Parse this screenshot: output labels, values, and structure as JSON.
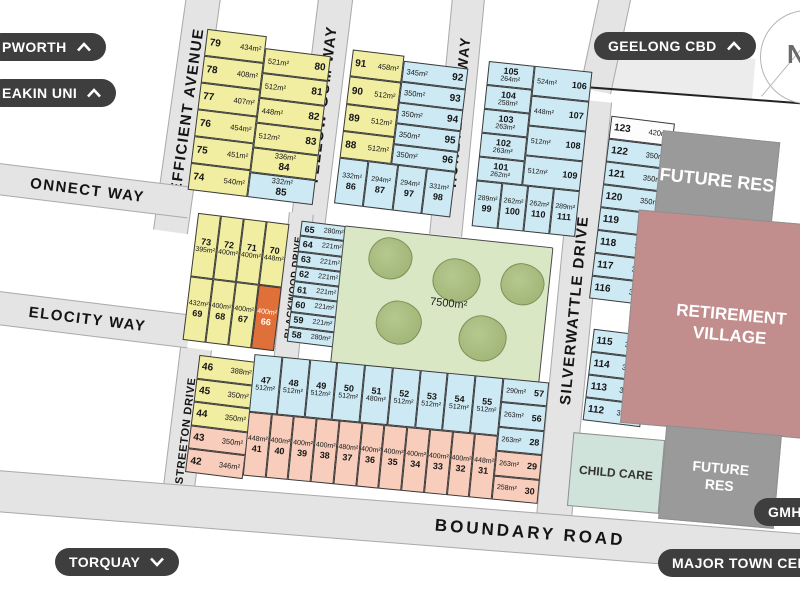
{
  "badges": {
    "top_left_1": {
      "label": "PWORTH",
      "chevron": "up"
    },
    "top_left_2": {
      "label": "EAKIN UNI",
      "chevron": "up"
    },
    "top_right": {
      "label": "GEELONG CBD",
      "chevron": "up"
    },
    "bottom_left": {
      "label": "TORQUAY",
      "chevron": "down"
    },
    "bottom_right_1": {
      "label": "GMHBA",
      "chevron": "none"
    },
    "bottom_right_2": {
      "label": "MAJOR TOWN CENTRE",
      "chevron": "none"
    }
  },
  "compass": {
    "label": "N"
  },
  "roads": {
    "efficient_avenue": "EFFICIENT AVENUE",
    "connect_way": "ONNECT WAY",
    "velocity_way": "ELOCITY WAY",
    "yellow_gum_way": "YELLOW GUM WAY",
    "honeyeater_way": "HONEYEATER WAY",
    "blackwood_drive": "BLACKWOOD DRIVE",
    "silverwattle_drive": "SILVERWATTLE DRIVE",
    "streeton_drive": "STREETON DRIVE",
    "boundary_road": "BOUNDARY ROAD"
  },
  "park": {
    "area_label": "7500m²"
  },
  "zones": {
    "future_res_top": "FUTURE RES",
    "retirement_village": "RETIREMENT VILLAGE",
    "child_care": "CHILD CARE",
    "future_res_bottom": "FUTURE RES"
  },
  "colors": {
    "lot_yellow": "#f1eda1",
    "lot_blue": "#cde9f4",
    "lot_salmon": "#f8cdbb",
    "lot_highlight_orange": "#e0703a",
    "park_green": "#d9e7c4",
    "tree_green": "#9cb173",
    "retirement_rose": "#c28e8d",
    "reserve_gray": "#9a9a9a",
    "childcare_teal": "#cfe3da",
    "road_gray": "#e4e4e4",
    "badge_dark": "#3e3e3e"
  },
  "lots": {
    "block_a_left": [
      {
        "n": "79",
        "a": "434m²",
        "c": "y",
        "v": "na"
      },
      {
        "n": "78",
        "a": "408m²",
        "c": "y",
        "v": "na"
      },
      {
        "n": "77",
        "a": "407m²",
        "c": "y",
        "v": "na"
      },
      {
        "n": "76",
        "a": "454m²",
        "c": "y",
        "v": "na"
      },
      {
        "n": "75",
        "a": "451m²",
        "c": "y",
        "v": "na"
      },
      {
        "n": "74",
        "a": "540m²",
        "c": "y",
        "v": "na"
      }
    ],
    "block_a_right": [
      {
        "n": "80",
        "a": "521m²",
        "c": "y",
        "v": "an"
      },
      {
        "n": "81",
        "a": "512m²",
        "c": "y",
        "v": "an"
      },
      {
        "n": "82",
        "a": "448m²",
        "c": "y",
        "v": "an"
      },
      {
        "n": "83",
        "a": "512m²",
        "c": "y",
        "v": "an"
      },
      {
        "n": "84",
        "a": "336m²",
        "c": "y",
        "v": "san"
      },
      {
        "n": "85",
        "a": "332m²",
        "c": "b",
        "v": "san"
      }
    ],
    "block_b_left": [
      {
        "n": "91",
        "a": "458m²",
        "c": "y",
        "v": "na"
      },
      {
        "n": "90",
        "a": "512m²",
        "c": "y",
        "v": "na"
      },
      {
        "n": "89",
        "a": "512m²",
        "c": "y",
        "v": "na"
      },
      {
        "n": "88",
        "a": "512m²",
        "c": "y",
        "v": "na"
      }
    ],
    "block_b_right": [
      {
        "n": "92",
        "a": "345m²",
        "c": "b",
        "v": "an"
      },
      {
        "n": "93",
        "a": "350m²",
        "c": "b",
        "v": "an"
      },
      {
        "n": "94",
        "a": "350m²",
        "c": "b",
        "v": "an"
      },
      {
        "n": "95",
        "a": "350m²",
        "c": "b",
        "v": "an"
      },
      {
        "n": "96",
        "a": "350m²",
        "c": "b",
        "v": "an"
      }
    ],
    "block_b_bottom": [
      {
        "n": "86",
        "a": "332m²",
        "c": "b",
        "v": "san"
      },
      {
        "n": "87",
        "a": "294m²",
        "c": "b",
        "v": "san"
      },
      {
        "n": "97",
        "a": "294m²",
        "c": "b",
        "v": "san"
      },
      {
        "n": "98",
        "a": "331m²",
        "c": "b",
        "v": "san"
      }
    ],
    "block_c_left": [
      {
        "n": "105",
        "a": "264m²",
        "c": "b",
        "v": "sna"
      },
      {
        "n": "104",
        "a": "258m²",
        "c": "b",
        "v": "sna"
      },
      {
        "n": "103",
        "a": "263m²",
        "c": "b",
        "v": "sna"
      },
      {
        "n": "102",
        "a": "263m²",
        "c": "b",
        "v": "sna"
      },
      {
        "n": "101",
        "a": "262m²",
        "c": "b",
        "v": "sna"
      }
    ],
    "block_c_right": [
      {
        "n": "106",
        "a": "524m²",
        "c": "b",
        "v": "an"
      },
      {
        "n": "107",
        "a": "448m²",
        "c": "b",
        "v": "an"
      },
      {
        "n": "108",
        "a": "512m²",
        "c": "b",
        "v": "an"
      },
      {
        "n": "109",
        "a": "512m²",
        "c": "b",
        "v": "an"
      }
    ],
    "block_c_bottom": [
      {
        "n": "99",
        "a": "289m²",
        "c": "b",
        "v": "san"
      },
      {
        "n": "100",
        "a": "262m²",
        "c": "b",
        "v": "san"
      },
      {
        "n": "110",
        "a": "262m²",
        "c": "b",
        "v": "san"
      },
      {
        "n": "111",
        "a": "289m²",
        "c": "b",
        "v": "san"
      }
    ],
    "block_d_top": [
      {
        "n": "123",
        "a": "420m²",
        "c": "w",
        "v": "na"
      },
      {
        "n": "122",
        "a": "350m²",
        "c": "b",
        "v": "na"
      },
      {
        "n": "121",
        "a": "350m²",
        "c": "b",
        "v": "na"
      },
      {
        "n": "120",
        "a": "350m²",
        "c": "b",
        "v": "na"
      },
      {
        "n": "119",
        "a": "350m²",
        "c": "b",
        "v": "na"
      },
      {
        "n": "118",
        "a": "350m²",
        "c": "b",
        "v": "na"
      },
      {
        "n": "117",
        "a": "392m²",
        "c": "b",
        "v": "na"
      },
      {
        "n": "116",
        "a": "388m²",
        "c": "b",
        "v": "na"
      }
    ],
    "block_d_bottom": [
      {
        "n": "115",
        "a": "388m²",
        "c": "b",
        "v": "na"
      },
      {
        "n": "114",
        "a": "350m²",
        "c": "b",
        "v": "na"
      },
      {
        "n": "113",
        "a": "350m²",
        "c": "b",
        "v": "na"
      },
      {
        "n": "112",
        "a": "350m²",
        "c": "b",
        "v": "na"
      }
    ],
    "block_e_top": [
      {
        "n": "73",
        "a": "395m²",
        "c": "y",
        "v": "sna"
      },
      {
        "n": "72",
        "a": "400m²",
        "c": "y",
        "v": "sna"
      },
      {
        "n": "71",
        "a": "400m²",
        "c": "y",
        "v": "sna"
      },
      {
        "n": "70",
        "a": "448m²",
        "c": "y",
        "v": "sna"
      }
    ],
    "block_e_bottom": [
      {
        "n": "69",
        "a": "432m²",
        "c": "y",
        "v": "san"
      },
      {
        "n": "68",
        "a": "400m²",
        "c": "y",
        "v": "san"
      },
      {
        "n": "67",
        "a": "400m²",
        "c": "y",
        "v": "san"
      },
      {
        "n": "66",
        "a": "400m²",
        "c": "o",
        "v": "san"
      }
    ],
    "block_f": [
      {
        "n": "65",
        "a": "280m²",
        "c": "b",
        "v": "na"
      },
      {
        "n": "64",
        "a": "221m²",
        "c": "b",
        "v": "na"
      },
      {
        "n": "63",
        "a": "221m²",
        "c": "b",
        "v": "na"
      },
      {
        "n": "62",
        "a": "221m²",
        "c": "b",
        "v": "na"
      },
      {
        "n": "61",
        "a": "221m²",
        "c": "b",
        "v": "na"
      },
      {
        "n": "60",
        "a": "221m²",
        "c": "b",
        "v": "na"
      },
      {
        "n": "59",
        "a": "221m²",
        "c": "b",
        "v": "na"
      },
      {
        "n": "58",
        "a": "280m²",
        "c": "b",
        "v": "na"
      }
    ],
    "block_g": [
      {
        "n": "46",
        "a": "388m²",
        "c": "y",
        "v": "na"
      },
      {
        "n": "45",
        "a": "350m²",
        "c": "y",
        "v": "na"
      },
      {
        "n": "44",
        "a": "350m²",
        "c": "y",
        "v": "na"
      },
      {
        "n": "43",
        "a": "350m²",
        "c": "s",
        "v": "na"
      },
      {
        "n": "42",
        "a": "346m²",
        "c": "s",
        "v": "na"
      }
    ],
    "block_h_top": [
      {
        "n": "47",
        "a": "512m²",
        "c": "b",
        "v": "sna"
      },
      {
        "n": "48",
        "a": "512m²",
        "c": "b",
        "v": "sna"
      },
      {
        "n": "49",
        "a": "512m²",
        "c": "b",
        "v": "sna"
      },
      {
        "n": "50",
        "a": "512m²",
        "c": "b",
        "v": "sna"
      },
      {
        "n": "51",
        "a": "480m²",
        "c": "b",
        "v": "sna"
      },
      {
        "n": "52",
        "a": "512m²",
        "c": "b",
        "v": "sna"
      },
      {
        "n": "53",
        "a": "512m²",
        "c": "b",
        "v": "sna"
      },
      {
        "n": "54",
        "a": "512m²",
        "c": "b",
        "v": "sna"
      },
      {
        "n": "55",
        "a": "512m²",
        "c": "b",
        "v": "sna"
      }
    ],
    "block_h_bottom": [
      {
        "n": "41",
        "a": "448m²",
        "c": "s",
        "v": "san"
      },
      {
        "n": "40",
        "a": "400m²",
        "c": "s",
        "v": "san"
      },
      {
        "n": "39",
        "a": "400m²",
        "c": "s",
        "v": "san"
      },
      {
        "n": "38",
        "a": "400m²",
        "c": "s",
        "v": "san"
      },
      {
        "n": "37",
        "a": "480m²",
        "c": "s",
        "v": "san"
      },
      {
        "n": "36",
        "a": "400m²",
        "c": "s",
        "v": "san"
      },
      {
        "n": "35",
        "a": "400m²",
        "c": "s",
        "v": "san"
      },
      {
        "n": "34",
        "a": "400m²",
        "c": "s",
        "v": "san"
      },
      {
        "n": "33",
        "a": "400m²",
        "c": "s",
        "v": "san"
      },
      {
        "n": "32",
        "a": "400m²",
        "c": "s",
        "v": "san"
      },
      {
        "n": "31",
        "a": "448m²",
        "c": "s",
        "v": "san"
      }
    ],
    "block_h_right": [
      {
        "n": "57",
        "a": "290m²",
        "c": "b",
        "v": "an"
      },
      {
        "n": "56",
        "a": "263m²",
        "c": "b",
        "v": "an"
      },
      {
        "n": "28",
        "a": "263m²",
        "c": "b",
        "v": "an"
      },
      {
        "n": "29",
        "a": "263m²",
        "c": "s",
        "v": "an"
      },
      {
        "n": "30",
        "a": "258m²",
        "c": "s",
        "v": "an"
      }
    ]
  }
}
